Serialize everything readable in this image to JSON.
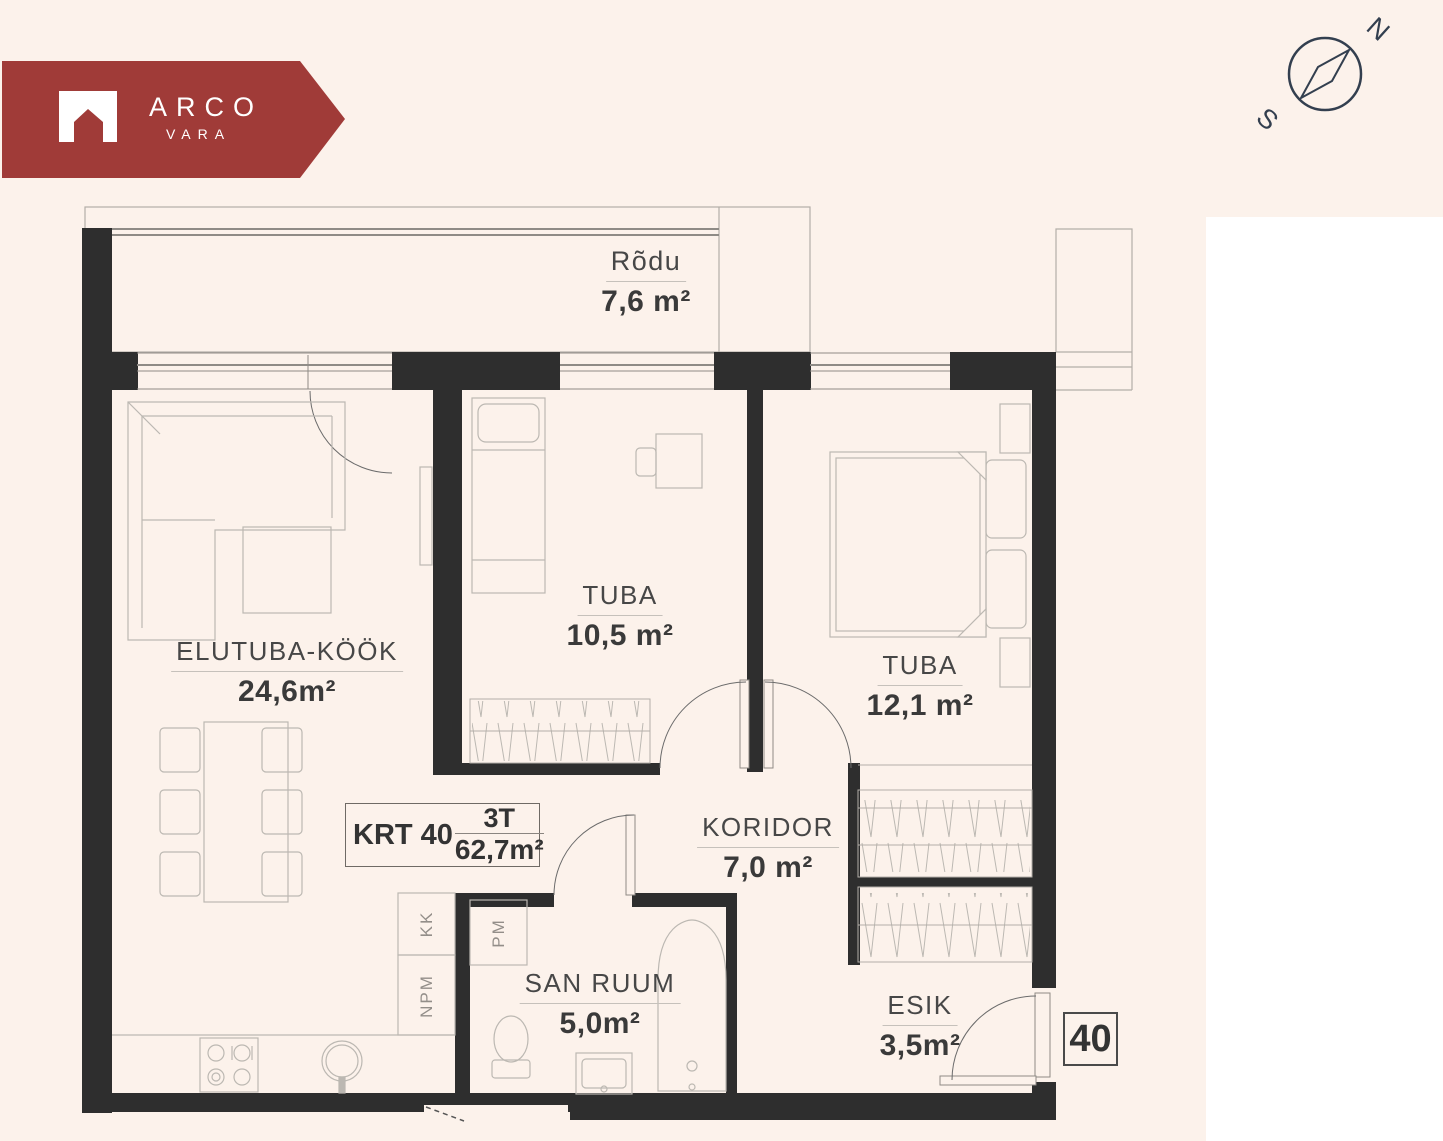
{
  "brand": {
    "name": "ARCO",
    "sub": "VARA"
  },
  "compass": {
    "north": "N",
    "south": "S"
  },
  "apartment": {
    "unit_label": "KRT 40",
    "type": "3T",
    "total_area": "62,7m²",
    "number": "40"
  },
  "rooms": [
    {
      "name": "Rõdu",
      "area": "7,6 m²"
    },
    {
      "name": "ELUTUBA-KÖÖK",
      "area": "24,6m²"
    },
    {
      "name": "TUBA",
      "area": "10,5 m²"
    },
    {
      "name": "TUBA",
      "area": "12,1 m²"
    },
    {
      "name": "KORIDOR",
      "area": "7,0 m²"
    },
    {
      "name": "SAN RUUM",
      "area": "5,0m²"
    },
    {
      "name": "ESIK",
      "area": "3,5m²"
    }
  ],
  "fixtures": {
    "kk": "KK",
    "npm": "NPM",
    "pm": "PM"
  },
  "colors": {
    "background": "#fcf2eb",
    "wall": "#2e2e2e",
    "brand_red": "#a03b38",
    "compass_navy": "#333f4f",
    "text": "#3a3a3a",
    "thin_line": "#b3aea8"
  }
}
